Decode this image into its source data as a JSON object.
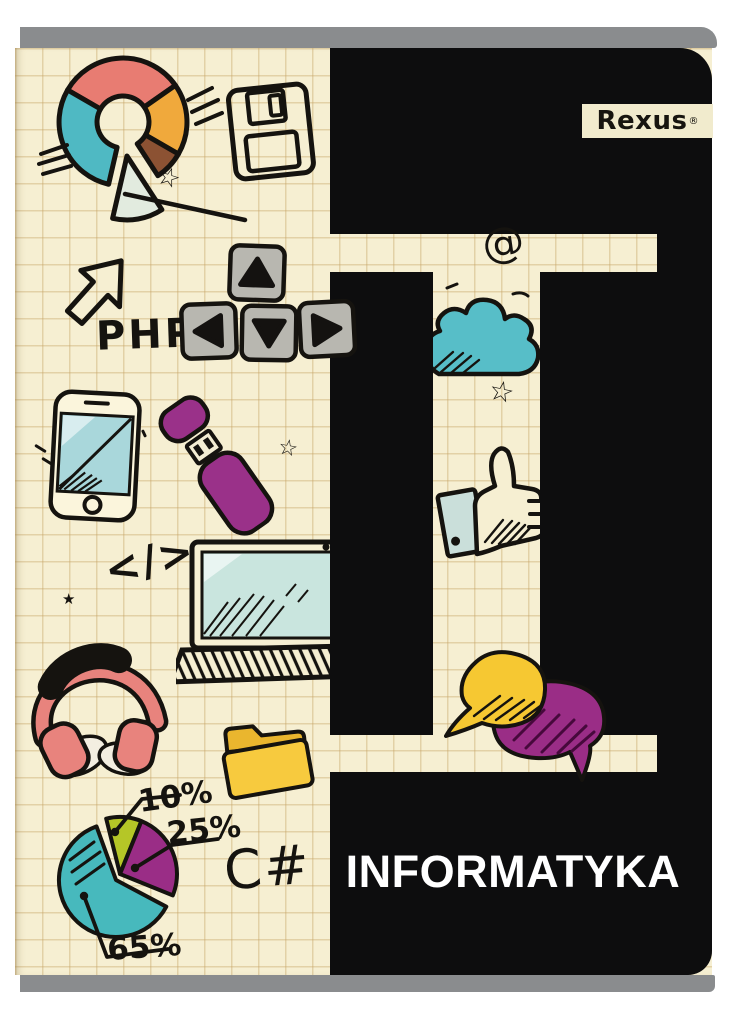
{
  "cover": {
    "brand": {
      "name": "Rexus",
      "registered": "®"
    },
    "title": "INFORMATYKA"
  },
  "doodle_labels": {
    "php": "PHP",
    "csharp": "C#",
    "at": "@",
    "code_tag": "</>",
    "star_outline": "☆",
    "star_filled": "★"
  },
  "pie_chart": {
    "labels": {
      "small": "10%",
      "medium": "25%",
      "large": "65%"
    }
  },
  "colors": {
    "paper": "#f6efd2",
    "cover_black": "#0d0d0e",
    "band_gray": "#8a8c8e",
    "teal": "#4fb9c3",
    "salmon": "#e87c72",
    "orange": "#f0a93c",
    "brown": "#8c5233",
    "purple": "#9a2d86",
    "yellow": "#f6c832",
    "lime": "#b5c627",
    "key_gray": "#b8b7b0",
    "screen_blue": "#a9d7db",
    "headphone_pink": "#e8837d",
    "cloud_teal": "#57bec8"
  },
  "chart_data": [
    {
      "type": "pie",
      "title": "hand-drawn pie chart doodle with percentage callouts",
      "labels": [
        "65%",
        "25%",
        "10%"
      ],
      "values": [
        65,
        25,
        10
      ],
      "colors": [
        "#47b9bd",
        "#9a2d86",
        "#b5c627"
      ],
      "annotations": [
        "10%",
        "25%",
        "65%"
      ]
    },
    {
      "type": "pie",
      "title": "hand-drawn donut chart doodle (unlabeled slices)",
      "labels": [
        "teal",
        "salmon",
        "orange",
        "brown",
        "detached slice"
      ],
      "values": [
        30,
        28,
        17,
        7,
        18
      ],
      "colors": [
        "#4fb9c3",
        "#e87c72",
        "#f0a93c",
        "#8c5233",
        "#e2ebdf"
      ]
    }
  ]
}
